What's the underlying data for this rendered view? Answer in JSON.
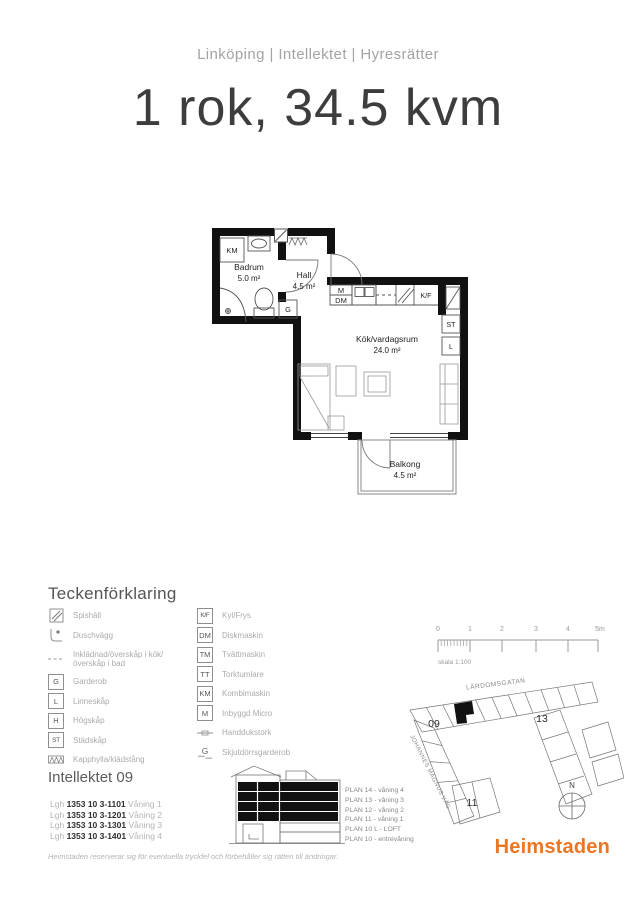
{
  "header": {
    "breadcrumb": "Linköping | Intellektet | Hyresrätter",
    "title": "1 rok, 34.5 kvm"
  },
  "floorplan": {
    "rooms": [
      {
        "name": "Badrum",
        "area": "5.0 m²"
      },
      {
        "name": "Hall",
        "area": "4.5 m²"
      },
      {
        "name": "Kök/vardagsrum",
        "area": "24.0 m²"
      },
      {
        "name": "Balkong",
        "area": "4.5 m²"
      }
    ],
    "labels": {
      "km": "KM",
      "g": "G",
      "m": "M",
      "dm": "DM",
      "kf": "K/F",
      "st": "ST",
      "l": "L"
    }
  },
  "legend": {
    "heading": "Teckenförklaring",
    "left": [
      {
        "icon": "spishall-icon",
        "label": "Spishäll"
      },
      {
        "icon": "duschvagg-icon",
        "label": "Duschvägg"
      },
      {
        "icon": "dashed-line-icon",
        "label": "Inklädnad/överskåp i kök/överskåp i bad"
      },
      {
        "symbol": "G",
        "label": "Garderob"
      },
      {
        "symbol": "L",
        "label": "Linneskåp"
      },
      {
        "symbol": "H",
        "label": "Högskåp"
      },
      {
        "symbol": "ST",
        "label": "Städskåp"
      },
      {
        "icon": "hatch-icon",
        "label": "Kapphylla/klädstång"
      }
    ],
    "right": [
      {
        "symbol": "K/F",
        "label": "Kyl/Frys"
      },
      {
        "symbol": "DM",
        "label": "Diskmaskin"
      },
      {
        "symbol": "TM",
        "label": "Tvättmaskin"
      },
      {
        "symbol": "TT",
        "label": "Torktumlare"
      },
      {
        "symbol": "KM",
        "label": "Kombimaskin"
      },
      {
        "symbol": "M",
        "label": "Inbyggd Micro"
      },
      {
        "icon": "handdukstork-icon",
        "label": "Handdukstork"
      },
      {
        "symbol": "G",
        "label": "Skjutdörrsgarderob"
      }
    ]
  },
  "scalebar": {
    "ticks": [
      "0",
      "1",
      "2",
      "3",
      "4",
      "5m"
    ],
    "caption": "skala 1:100"
  },
  "siteplan": {
    "street_top": "LÄRDOMSGATAN",
    "street_left": "JOHANNES MAGNUS VÄG",
    "building_09": "09",
    "building_11": "11",
    "building_13": "13",
    "north": "N"
  },
  "building_info": {
    "heading": "Intellektet 09",
    "apartments": [
      {
        "prefix": "Lgh",
        "number": "1353 10 3-1101",
        "floor": "Våning 1"
      },
      {
        "prefix": "Lgh",
        "number": "1353 10 3-1201",
        "floor": "Våning 2"
      },
      {
        "prefix": "Lgh",
        "number": "1353 10 3-1301",
        "floor": "Våning 3"
      },
      {
        "prefix": "Lgh",
        "number": "1353 10 3-1401",
        "floor": "Våning 4"
      }
    ],
    "plans": [
      "PLAN 14 - våning 4",
      "PLAN 13 - våning 3",
      "PLAN 12 - våning 2",
      "PLAN 11 - våning 1",
      "PLAN 10 L - LOFT",
      "PLAN 10 - entrévåning"
    ]
  },
  "footer": {
    "disclaimer": "Heimstaden reserverar sig för eventuella tryckfel och förbehåller sig rätten till ändringar.",
    "logo": "Heimstaden"
  },
  "colors": {
    "brand_orange": "#ED7623",
    "wall_black": "#111111"
  }
}
